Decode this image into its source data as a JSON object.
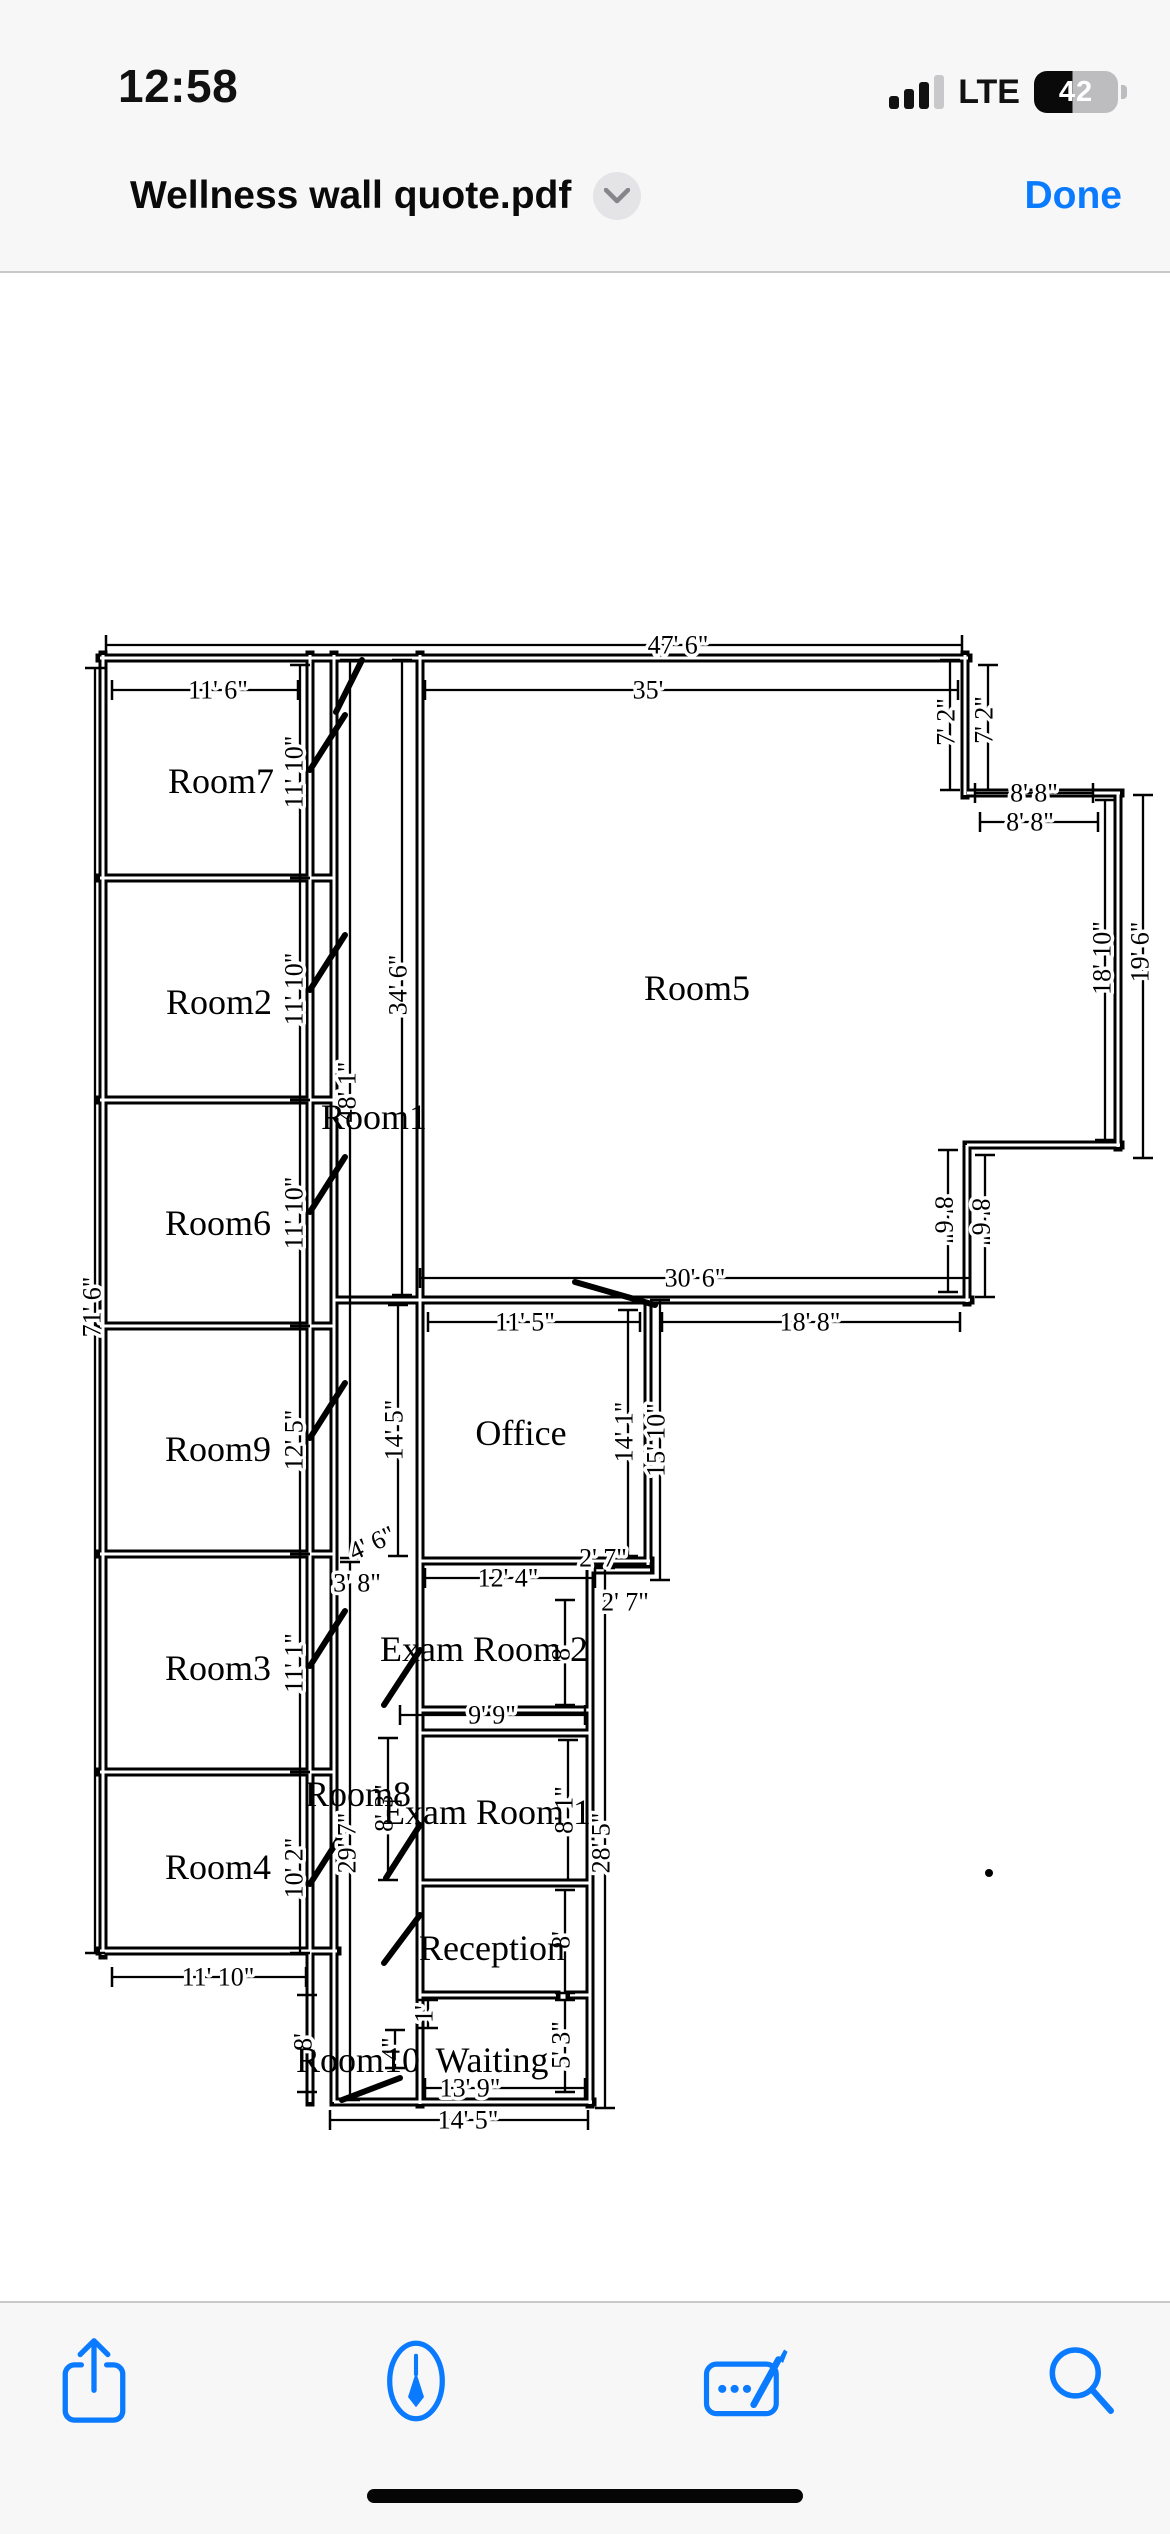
{
  "accent_color": "#0a7aff",
  "status_bar": {
    "time": "12:58",
    "network": "LTE",
    "battery_percent": "42"
  },
  "title_bar": {
    "title": "Wellness wall quote.pdf",
    "done_label": "Done"
  },
  "toolbar": {
    "icons": [
      "share",
      "markup",
      "fill-and-sign",
      "search"
    ]
  },
  "plan": {
    "rooms": {
      "room7": "Room7",
      "room2": "Room2",
      "room6": "Room6",
      "room9": "Room9",
      "room3": "Room3",
      "room4": "Room4",
      "room1": "Room1",
      "room5": "Room5",
      "office": "Office",
      "exam2": "Exam Room 2",
      "room8": "Room8",
      "exam1": "Exam Room 1",
      "reception": "Reception",
      "room10": "Room10",
      "waiting": "Waiting"
    },
    "dims": {
      "total_top": "47' 6\"",
      "room7_top": "11' 6\"",
      "room5_top": "35'",
      "notch_top_a": "8' 8\"",
      "notch_top_b": "8' 8\"",
      "room5_bottom": "30' 6\"",
      "office_top": "11' 5\"",
      "right_bottom": "18' 8\"",
      "exam2_top": "12' 4\"",
      "jog_a": "2' 7\"",
      "jog_b": "2' 7\"",
      "exam1_top": "9' 9\"",
      "waiting_bottom": "13' 9\"",
      "bottom_total": "14' 5\"",
      "room4_bottom": "11' 10\"",
      "door_a": "4' 6\"",
      "door_b": "3' 8\"",
      "left_total": "71' 6\"",
      "room7_side": "11' 10\"",
      "room2_side": "11' 10\"",
      "room6_side": "11' 10\"",
      "room9_side": "12' 5\"",
      "room3_side": "11' 1\"",
      "room4_side": "10' 2\"",
      "room5_left": "34' 6\"",
      "corridor": "48' 1\"",
      "notch_a": "7' 2\"",
      "notch_b": "7' 2\"",
      "notch_right": "18' 10\"",
      "right_total": "19' 6\"",
      "step_a": "8' 6\"",
      "step_b": "8' 6\"",
      "office_left": "14' 5\"",
      "office_right": "14' 1\"",
      "office_outer": "15' 10\"",
      "exam2_right": "8'",
      "corridor_lower": "29' 7\"",
      "exam_outer": "28' 5\"",
      "exam1_left": "8' 3\"",
      "exam1_right": "8' 1\"",
      "reception_right": "8'",
      "waiting_right": "5' 3\"",
      "desk": "1'",
      "room10_step": "4\"",
      "room10_left": "8'"
    }
  }
}
